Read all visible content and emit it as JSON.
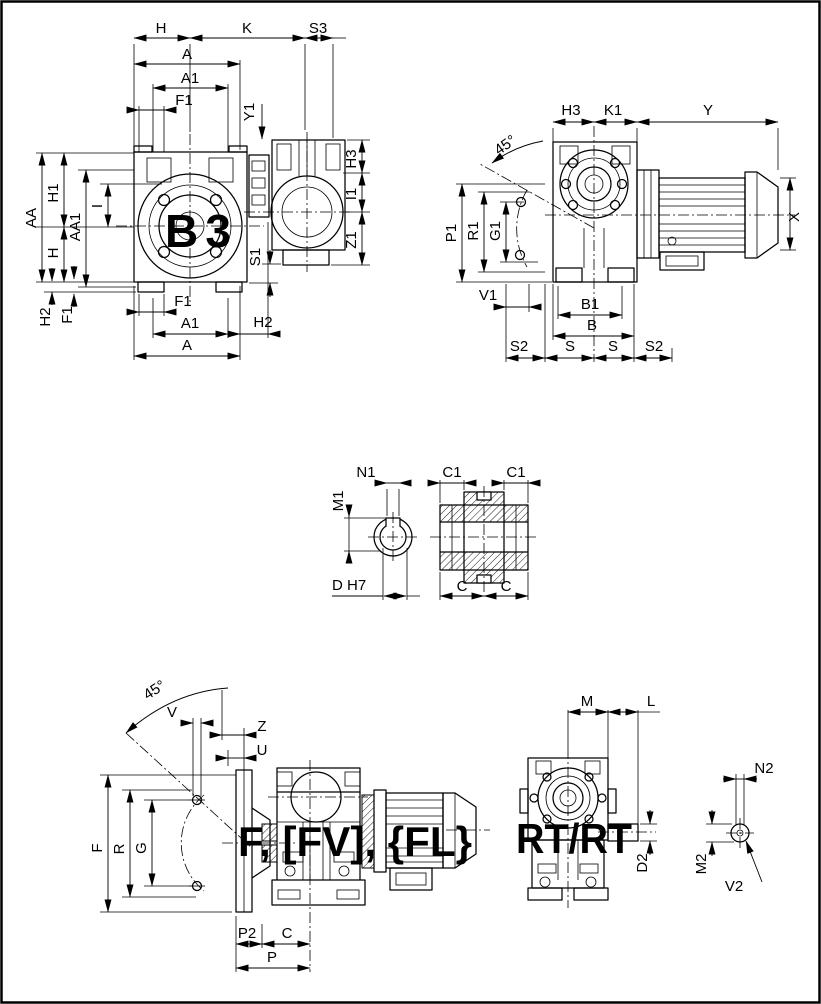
{
  "colors": {
    "line": "#000000",
    "accent_green": "#0a8a0a",
    "background": "#ffffff"
  },
  "views": {
    "b3": {
      "tag": "B3",
      "labels": {
        "h_top": "H",
        "k": "K",
        "s3": "S3",
        "a_top": "A",
        "a1_top": "A1",
        "f1_top": "F1",
        "y1": "Y1",
        "aa": "AA",
        "h1": "H1",
        "aa1": "AA1",
        "i": "I",
        "h_left": "H",
        "h2_left": "H2",
        "f1_left": "F1",
        "s1": "S1",
        "h3": "H3",
        "i1": "I1",
        "z1": "Z1",
        "f1_bottom": "F1",
        "a1_bottom": "A1",
        "h2_bottom": "H2",
        "a_bottom": "A"
      }
    },
    "motor_side": {
      "labels": {
        "angle": "45°",
        "h3": "H3",
        "k1": "K1",
        "y": "Y",
        "p1": "P1",
        "r1": "R1",
        "g1": "G1",
        "x": "X",
        "v1": "V1",
        "b1": "B1",
        "b": "B",
        "s2_left": "S2",
        "s_left": "S",
        "s_right": "S",
        "s2_right": "S2"
      }
    },
    "hollow_shaft": {
      "labels": {
        "n1": "N1",
        "m1": "M1",
        "d_h7": "D H7",
        "c1_left": "C1",
        "c1_right": "C1",
        "c_left": "C",
        "c_right": "C"
      }
    },
    "flange_version": {
      "tag": "F, [FV], {FL}",
      "labels": {
        "angle": "45°",
        "v": "V",
        "z": "Z",
        "u": "U",
        "f": "F",
        "r": "R",
        "g": "G",
        "p2": "P2",
        "c": "C",
        "p": "P"
      }
    },
    "torque_arm_version": {
      "tag": "RT/RT",
      "labels": {
        "m": "M",
        "l": "L",
        "d2": "D2",
        "n2": "N2",
        "m2": "M2",
        "v2": "V2"
      }
    }
  }
}
